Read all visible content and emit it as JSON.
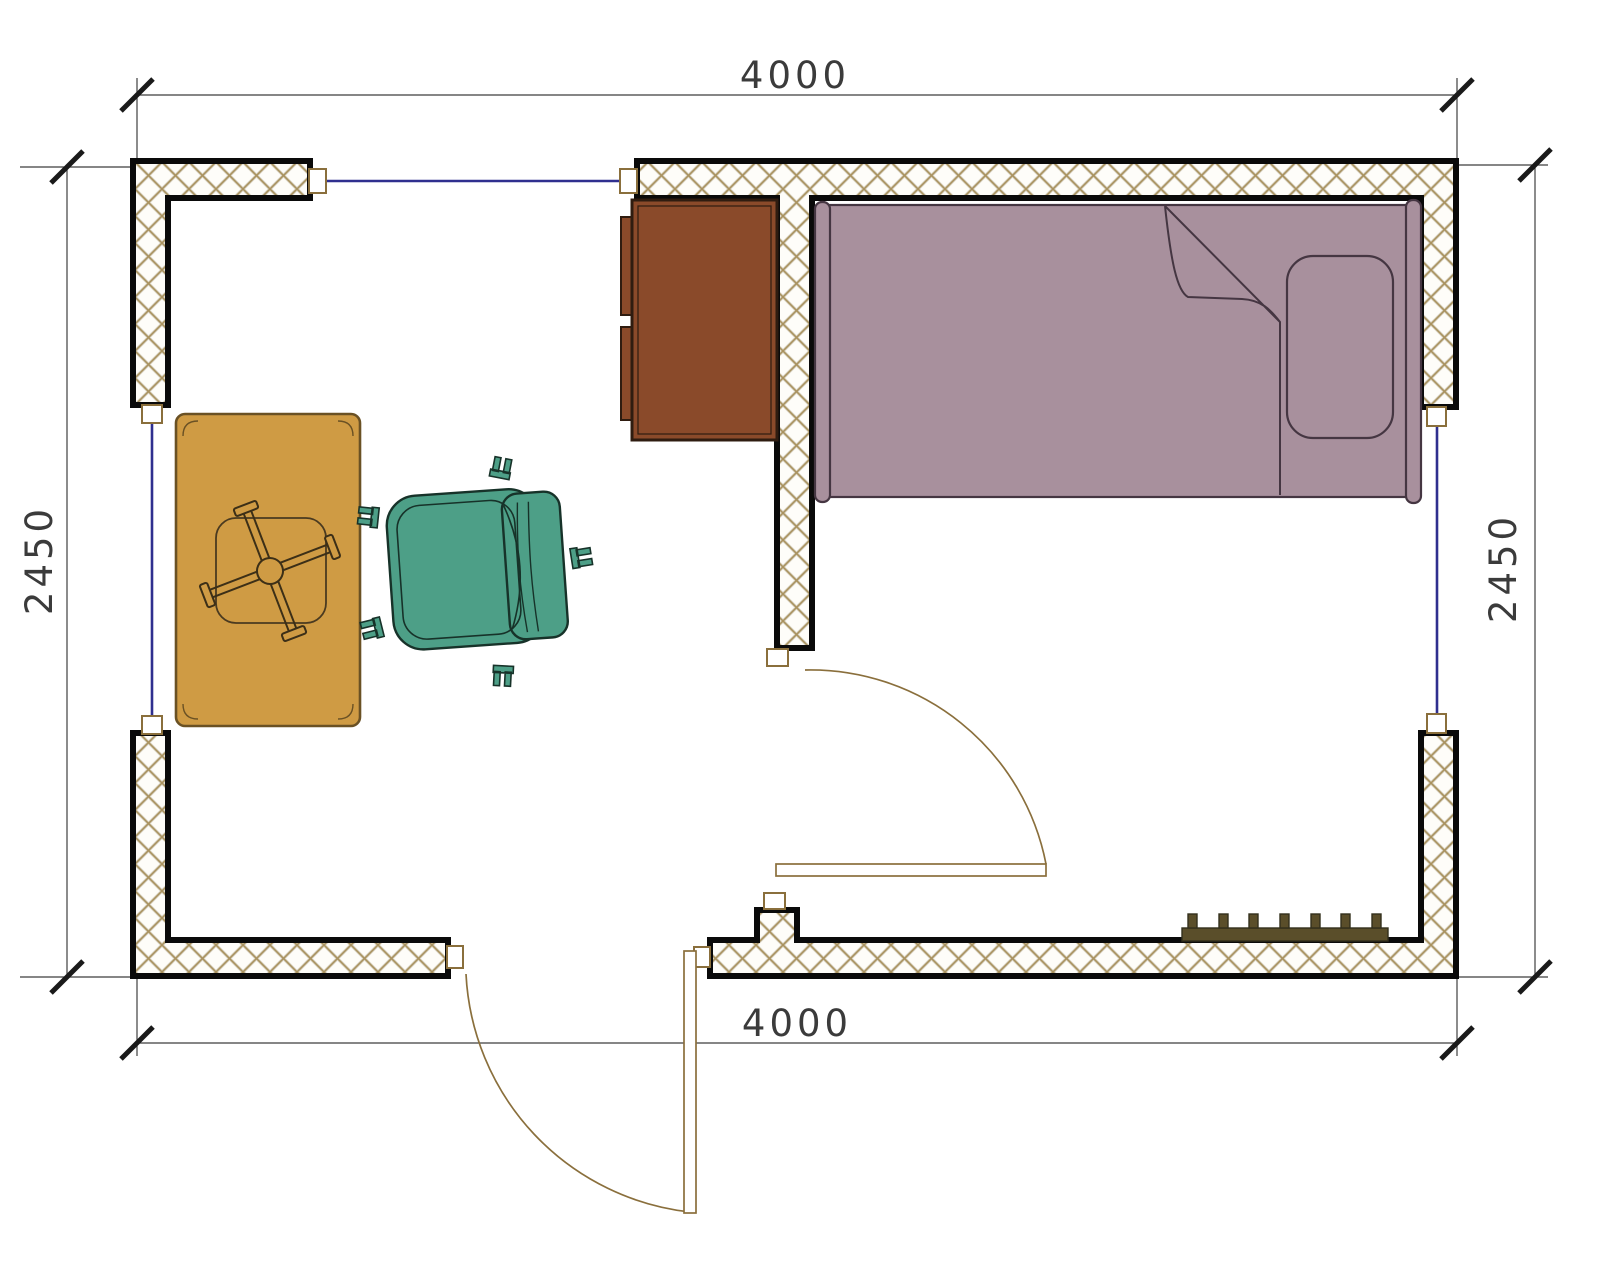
{
  "drawing": {
    "type": "architectural floor plan, single room",
    "dimensions": {
      "top": "4000",
      "bottom": "4000",
      "left": "2450",
      "right": "2450"
    },
    "objects": [
      {
        "name": "exterior-walls",
        "style": "crosshatched masonry"
      },
      {
        "name": "partition-wall"
      },
      {
        "name": "window-top"
      },
      {
        "name": "window-left"
      },
      {
        "name": "window-right"
      },
      {
        "name": "interior-door",
        "swing": "quarter-arc"
      },
      {
        "name": "entry-door",
        "swing": "quarter-arc"
      },
      {
        "name": "wardrobe-cabinet"
      },
      {
        "name": "single-bed",
        "parts": [
          "mattress",
          "pillow",
          "blanket-fold",
          "rails"
        ]
      },
      {
        "name": "table",
        "parts": [
          "top",
          "pedestal-cross-base"
        ]
      },
      {
        "name": "office-chair",
        "parts": [
          "seat",
          "backrest",
          "5 casters"
        ]
      },
      {
        "name": "radiator",
        "fins": 7
      }
    ],
    "colors": {
      "wall_hatch": "#a9925f",
      "wall_outline": "#0a0a0a",
      "window_line": "#2f2f8f",
      "door_line": "#8a6f3c",
      "wardrobe": "#8a4a2a",
      "bed": "#a8909d",
      "table": "#cf9b44",
      "chair": "#4d9f87",
      "radiator": "#5a4e2a",
      "dimension_text": "#3b3b3b"
    }
  }
}
